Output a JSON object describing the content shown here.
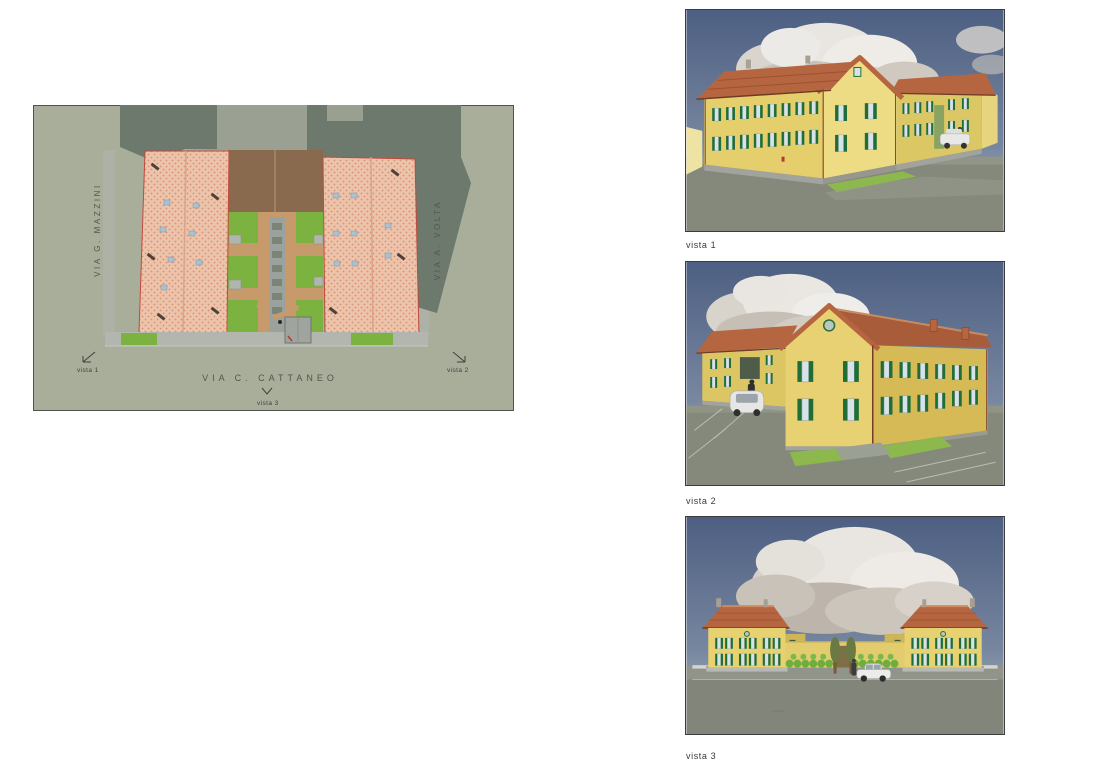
{
  "page": {
    "background": "#ffffff"
  },
  "site_plan": {
    "street_left": "VIA G. MAZZINI",
    "street_right": "VIA A. VOLTA",
    "street_bottom": "VIA C. CATTANEO",
    "marker_1": "vista 1",
    "marker_2": "vista 2",
    "marker_3": "vista 3",
    "colors": {
      "ground": "#a9ae9b",
      "shadow": "#6d796d",
      "roof_tile": "#ecc3ab",
      "roof_dots": "#d8906f",
      "roof_outline": "#bf4a3c",
      "lawn": "#7cb23f",
      "dirt": "#8a6a4e",
      "path": "#c79a6b",
      "pavement": "#b3b6ae"
    }
  },
  "renderings": [
    {
      "caption": "vista 1"
    },
    {
      "caption": "vista 2"
    },
    {
      "caption": "vista 3"
    }
  ],
  "palette": {
    "sky_top": "#4d5f82",
    "sky_bottom": "#98a3b0",
    "cloud": "#eae7e2",
    "wall_yellow": "#e5ce6c",
    "wall_shaded": "#d5ba55",
    "shutter_green": "#1f6e38",
    "roof_terracotta": "#b5653f",
    "ground_gray": "#85897c",
    "lawn_green": "#8cb84e"
  }
}
